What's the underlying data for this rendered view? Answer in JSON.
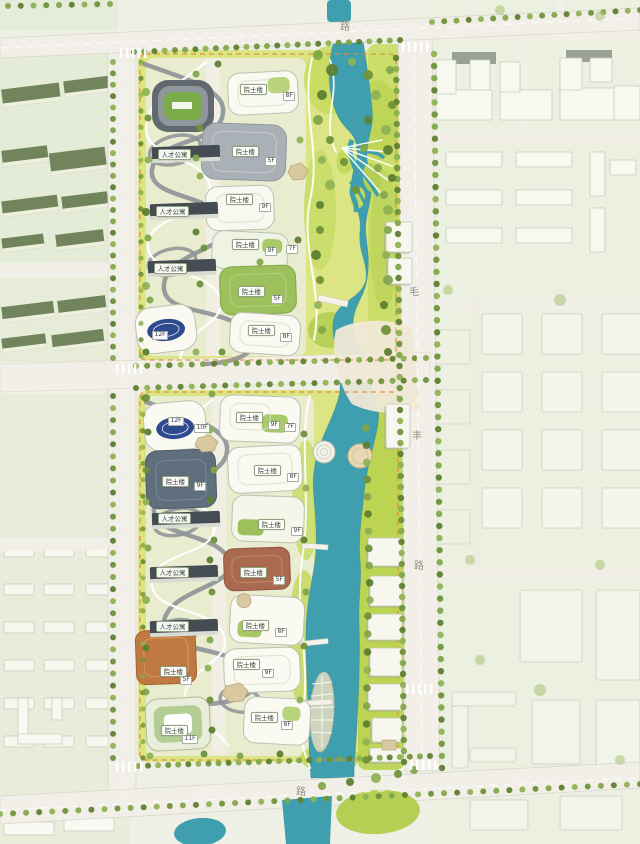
{
  "road_labels": [
    {
      "text": "路",
      "x": 340,
      "y": 18
    },
    {
      "text": "毛",
      "x": 409,
      "y": 283
    },
    {
      "text": "丰",
      "x": 412,
      "y": 427
    },
    {
      "text": "路",
      "x": 414,
      "y": 557
    },
    {
      "text": "路",
      "x": 296,
      "y": 783
    }
  ],
  "building_labels": [
    {
      "text": "院士楼",
      "floor": "8F",
      "x": 240,
      "y": 84,
      "fx": 283,
      "fy": 92
    },
    {
      "text": "院士楼",
      "floor": "5F",
      "x": 232,
      "y": 146,
      "fx": 265,
      "fy": 157
    },
    {
      "text": "院士楼",
      "floor": "9F",
      "x": 226,
      "y": 194,
      "fx": 259,
      "fy": 203
    },
    {
      "text": "院士楼",
      "floor": "9F",
      "x": 232,
      "y": 239,
      "fx": 265,
      "fy": 247
    },
    {
      "text": "",
      "floor": "7F",
      "x": 286,
      "y": 245
    },
    {
      "text": "院士楼",
      "floor": "5F",
      "x": 238,
      "y": 286,
      "fx": 271,
      "fy": 295
    },
    {
      "text": "院士楼",
      "floor": "8F",
      "x": 248,
      "y": 325,
      "fx": 280,
      "fy": 333
    },
    {
      "text": "",
      "floor": "12F",
      "x": 152,
      "y": 331
    },
    {
      "text": "人才公寓",
      "floor": "",
      "x": 158,
      "y": 149
    },
    {
      "text": "人才公寓",
      "floor": "",
      "x": 156,
      "y": 206
    },
    {
      "text": "人才公寓",
      "floor": "",
      "x": 154,
      "y": 263
    },
    {
      "text": "",
      "floor": "12F",
      "x": 168,
      "y": 417
    },
    {
      "text": "",
      "floor": "10F",
      "x": 194,
      "y": 424
    },
    {
      "text": "院士楼",
      "floor": "9F",
      "x": 236,
      "y": 412,
      "fx": 268,
      "fy": 421
    },
    {
      "text": "",
      "floor": "7F",
      "x": 284,
      "y": 423
    },
    {
      "text": "院士楼",
      "floor": "9F",
      "x": 162,
      "y": 476,
      "fx": 194,
      "fy": 482
    },
    {
      "text": "院士楼",
      "floor": "8F",
      "x": 254,
      "y": 465,
      "fx": 287,
      "fy": 473
    },
    {
      "text": "院士楼",
      "floor": "9F",
      "x": 258,
      "y": 519,
      "fx": 291,
      "fy": 527
    },
    {
      "text": "院士楼",
      "floor": "5F",
      "x": 240,
      "y": 567,
      "fx": 273,
      "fy": 576
    },
    {
      "text": "院士楼",
      "floor": "8F",
      "x": 242,
      "y": 620,
      "fx": 275,
      "fy": 628
    },
    {
      "text": "院士楼",
      "floor": "5F",
      "x": 160,
      "y": 666,
      "fx": 180,
      "fy": 676
    },
    {
      "text": "院士楼",
      "floor": "9F",
      "x": 233,
      "y": 659,
      "fx": 262,
      "fy": 669
    },
    {
      "text": "院士楼",
      "floor": "8F",
      "x": 251,
      "y": 712,
      "fx": 281,
      "fy": 721
    },
    {
      "text": "院士楼",
      "floor": "11F",
      "x": 161,
      "y": 725,
      "fx": 182,
      "fy": 735
    },
    {
      "text": "人才公寓",
      "floor": "",
      "x": 158,
      "y": 513
    },
    {
      "text": "人才公寓",
      "floor": "",
      "x": 156,
      "y": 567
    },
    {
      "text": "人才公寓",
      "floor": "",
      "x": 156,
      "y": 621
    }
  ],
  "colors": {
    "water": "#3f9fae",
    "landscape": "#dce584",
    "boundary_dash": "#e08a35",
    "road": "#f1efe8",
    "context_green": "#e9efdd"
  }
}
